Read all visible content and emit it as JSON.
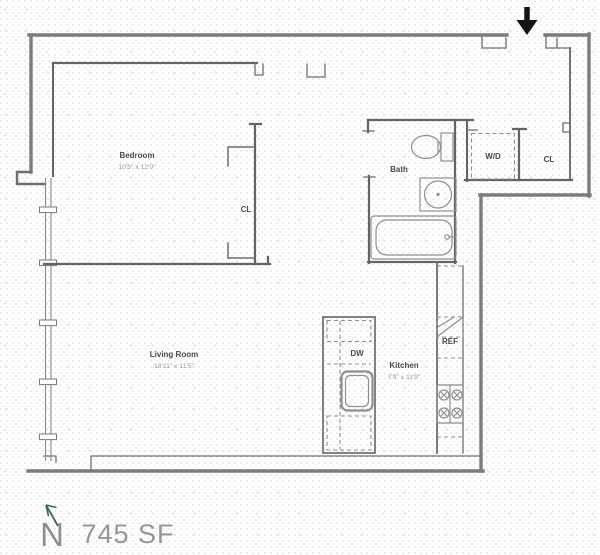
{
  "plan": {
    "area_label": "745 SF",
    "north_label": "N",
    "rooms": {
      "bedroom": {
        "name": "Bedroom",
        "dims": "10'5\" x 12'0\""
      },
      "living_room": {
        "name": "Living Room",
        "dims": "18'11\" x 11'5\""
      },
      "kitchen": {
        "name": "Kitchen",
        "dims": "7'9\" x 11'9\""
      },
      "bath": {
        "name": "Bath"
      }
    },
    "fixtures": {
      "washer_dryer": "W/D",
      "closet_entry": "CL",
      "closet_bedroom": "CL",
      "refrigerator": "REF",
      "dishwasher": "DW"
    },
    "colors": {
      "wall_interior": "#646464",
      "wall_exterior": "#7c7c7c",
      "fixture_line": "#8f8f8f",
      "room_label": "#4a4a4a",
      "dim_text": "#9b9b9b",
      "area_text": "#979797",
      "north_arrow": "#3c6360",
      "entry_arrow": "#151515"
    }
  }
}
